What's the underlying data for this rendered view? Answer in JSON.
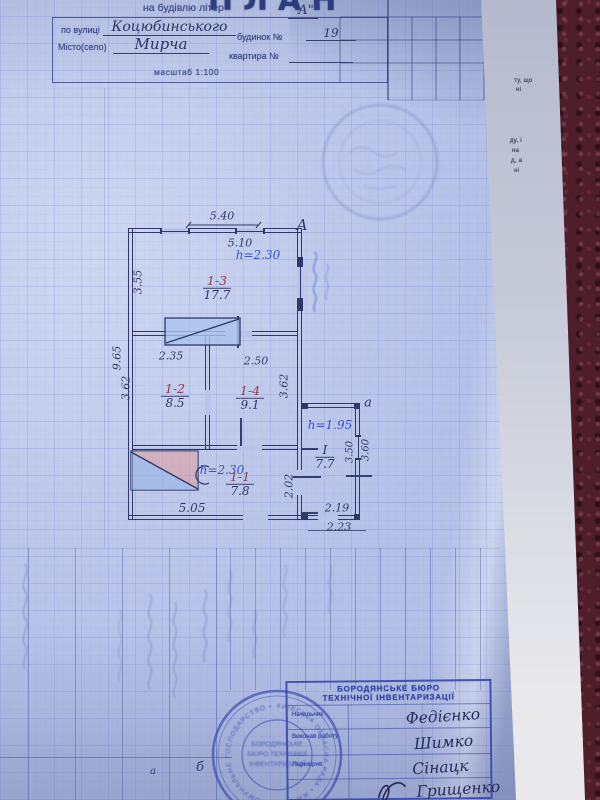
{
  "header": {
    "title": "ПЛАН",
    "subtitle": "на будівлю літер",
    "letter_value": "\"А\"",
    "street_label": "по вулиці",
    "street_value": "Коцюбинського",
    "house_label": "будинок №",
    "house_value": "19",
    "city_label": "Місто(село)",
    "city_value": "Мирча",
    "apartment_label": "квартира №",
    "scale": "масштаб 1:100"
  },
  "plan": {
    "main_building_letter": "А",
    "annex_letter": "а",
    "rooms": [
      {
        "number": "1-3",
        "area": "17.7"
      },
      {
        "number": "1-2",
        "area": "8.5"
      },
      {
        "number": "1-4",
        "area": "9.1"
      },
      {
        "number": "1-1",
        "area": "7.8"
      },
      {
        "number": "І",
        "area": "7.7"
      }
    ],
    "heights": {
      "room_1_3": "h=2.30",
      "room_1_1": "h=2.30",
      "annex": "h=1.95"
    },
    "dimensions": {
      "top_outer": "5.40",
      "top_inner": "5.10",
      "left_upper": "3.55",
      "left_outer": "9.65",
      "partition_left": "2.35",
      "partition_right": "2.50",
      "left_middle": "3.62",
      "right_middle": "3.62",
      "bottom_inner": "5.05",
      "right_lower": "2.02",
      "annex_right_inner": "3.50",
      "annex_right_outer": "3.60",
      "annex_bottom_inner": "2.19",
      "annex_bottom_outer": "2.23"
    }
  },
  "bottom_table": {
    "cell_a": "а",
    "cell_b": "б"
  },
  "stamp_rect": {
    "line1": "БОРОДЯНСЬКЕ БЮРО",
    "line2": "ТЕХНІЧНОЇ ІНВЕНТАРИЗАЦІЇ",
    "roles": [
      "Начальник",
      "Виконав роботу",
      "Перевірив"
    ],
    "signatures": [
      "Федієнко",
      "Шимко",
      "Сінацк",
      "Грищенко"
    ]
  },
  "stamp_round": {
    "ring": "КИЇВСЬКА ОБЛАСНА РАДА • ЖИТЛОВО-КОМУНАЛЬНЕ ГОСПОДАРСТВО •",
    "inner": [
      "БОРОДЯНСЬКЕ",
      "БЮРО ТЕХНІЧНОЇ",
      "ІНВЕНТАРИЗАЦІЇ"
    ]
  },
  "underpaper": {
    "fragments": [
      "ту, що",
      "ні",
      "ду, і",
      "на",
      "д, а",
      "ні"
    ]
  }
}
